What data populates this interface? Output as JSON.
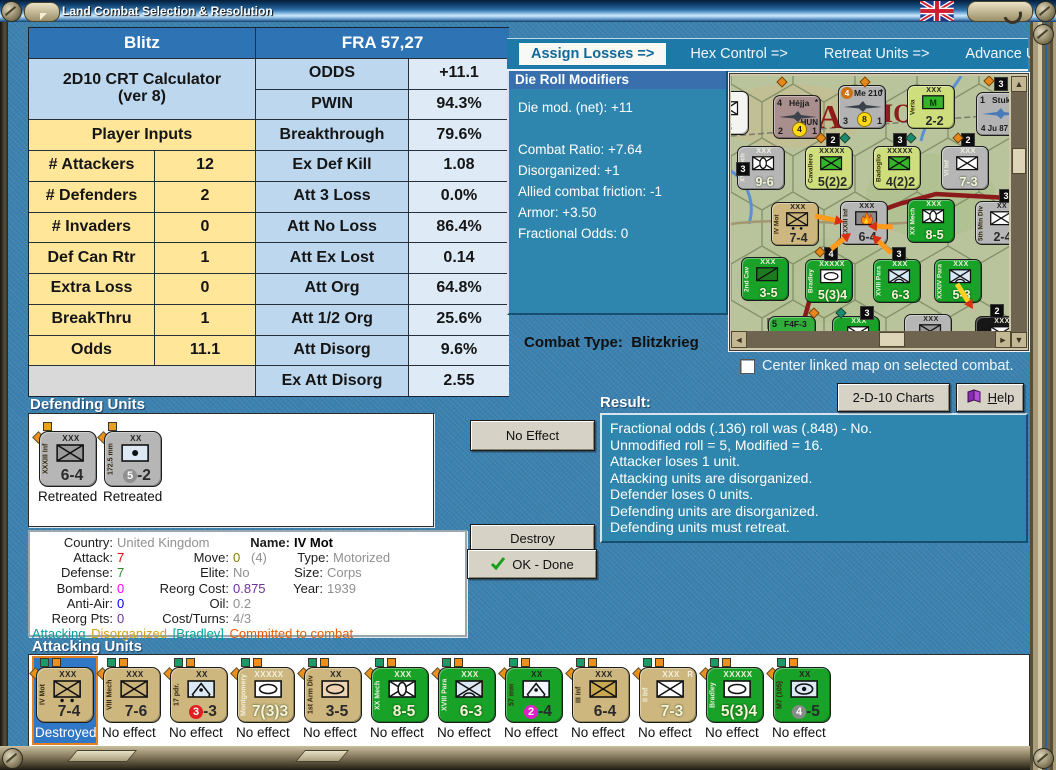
{
  "window": {
    "title": "Land Combat Selection & Resolution"
  },
  "colors": {
    "bg": "#3d83b0",
    "teal_panel": "#2e86ae",
    "panel_title_bar": "#3a6fae",
    "tab_bar": "#1d7aa8",
    "tab_active_text": "#11699b",
    "table_header": "#2e74b5",
    "table_light_blue": "#bdd7ee",
    "table_lighter_blue": "#deebf7",
    "table_yellow": "#ffe699",
    "table_gray": "#d9d9d9",
    "button_face": "#d6d2c6",
    "counter_tan": "#cdb77f",
    "counter_green": "#18a227",
    "counter_gray": "#b6b6b6",
    "counter_ygreen": "#cede7c",
    "selected_blue": "#2f78c8",
    "arrow_orange": "#ff9a1c"
  },
  "tabs": [
    {
      "label": "Assign Losses =>",
      "active": true
    },
    {
      "label": "Hex Control =>",
      "active": false
    },
    {
      "label": "Retreat Units =>",
      "active": false
    },
    {
      "label": "Advance Units",
      "active": false
    }
  ],
  "crt": {
    "left_header": "Blitz",
    "right_header": "FRA 57,27",
    "calc_title_1": "2D10 CRT Calculator",
    "calc_title_2": "(ver 8)",
    "inputs_header": "Player Inputs",
    "inputs": [
      [
        "# Attackers",
        "12"
      ],
      [
        "# Defenders",
        "2"
      ],
      [
        "# Invaders",
        "0"
      ],
      [
        "Def Can Rtr",
        "1"
      ],
      [
        "Extra Loss",
        "0"
      ],
      [
        "BreakThru",
        "1"
      ],
      [
        "Odds",
        "11.1"
      ]
    ],
    "outputs": [
      [
        "ODDS",
        "+11.1"
      ],
      [
        "PWIN",
        "94.3%"
      ],
      [
        "Breakthrough",
        "79.6%"
      ],
      [
        "Ex Def Kill",
        "1.08"
      ],
      [
        "Att 3 Loss",
        "0.0%"
      ],
      [
        "Att No Loss",
        "86.4%"
      ],
      [
        "Att Ex Lost",
        "0.14"
      ],
      [
        "Att Org",
        "64.8%"
      ],
      [
        "Att 1/2 Org",
        "25.6%"
      ],
      [
        "Att Disorg",
        "9.6%"
      ],
      [
        "Ex Att Disorg",
        "2.55"
      ]
    ]
  },
  "die_modifiers": {
    "title": "Die Roll Modifiers",
    "net": "Die mod. (net): +11",
    "lines": [
      "Combat Ratio: +7.64",
      "Disorganized: +1",
      "Allied combat friction: -1",
      "Armor: +3.50",
      "Fractional Odds: 0"
    ]
  },
  "combat_type": {
    "label": "Combat Type:",
    "value": "Blitzkrieg"
  },
  "map_controls": {
    "checkbox_label": "Center linked map on selected combat.",
    "checkbox_checked": false,
    "charts_button": "2-D-10 Charts",
    "help_button": "Help"
  },
  "map": {
    "labels": [
      {
        "t": "RA",
        "x": 62,
        "y": 52,
        "s": 34
      },
      {
        "t": "IO",
        "x": 152,
        "y": 46,
        "s": 26
      }
    ],
    "units": [
      {
        "t": "g",
        "name": "",
        "size": "R",
        "sym": "inf",
        "sym_fill": "#ffffff",
        "str": "3",
        "color": "wht",
        "x": -30,
        "y": 15
      },
      {
        "t": "a",
        "color": "#a98e8e",
        "tl": "4",
        "name": "Héjja",
        "star": "*",
        "extra": "HUN",
        "bl": "2",
        "circ": "4",
        "br": "1",
        "x": 42,
        "y": 19
      },
      {
        "t": "a",
        "color": "#b3b3b3",
        "tl_circ": "#d07010",
        "tl": "4",
        "name": "Me 210",
        "star": "*",
        "bl": "3",
        "circ": "8",
        "br": "1",
        "x": 107,
        "y": 9
      },
      {
        "t": "g",
        "name": "Veria",
        "size": "XXX",
        "sym": "m",
        "sym_fill": "#35b42a",
        "str": "2-2",
        "color": "ygreen",
        "x": 176,
        "y": 9
      },
      {
        "t": "a",
        "color": "#b3b3b3",
        "tl": "1",
        "name": "Stuka",
        "sub": "4  Ju 87",
        "plane_color": "#4a7ab8",
        "x": 245,
        "y": 16
      },
      {
        "t": "g",
        "name": "XVI Mech",
        "size": "XXX",
        "sym": "mech",
        "sym_fill": "#ffffff",
        "str": "9-6",
        "color": "gray",
        "light": true,
        "x": 6,
        "y": 70
      },
      {
        "t": "g",
        "name": "Cavallero",
        "size": "XXXXX",
        "sym": "inf",
        "sym_fill": "#35b42a",
        "str": "5(2)2",
        "color": "ygreen",
        "x": 74,
        "y": 70
      },
      {
        "t": "g",
        "name": "Badoglio",
        "size": "XXXXX",
        "sym": "inf",
        "sym_fill": "#35b42a",
        "str": "4(2)2",
        "color": "ygreen",
        "x": 142,
        "y": 70
      },
      {
        "t": "g",
        "name": "VI Inf",
        "size": "XXX",
        "sym": "inf",
        "sym_fill": "#ffffff",
        "str": "7-3",
        "color": "gray",
        "light": true,
        "x": 210,
        "y": 70
      },
      {
        "t": "g",
        "name": "IV Mot",
        "size": "XXX",
        "sym": "mot",
        "sym_fill": "#c9b378",
        "str": "7-4",
        "color": "tan",
        "x": 40,
        "y": 126
      },
      {
        "t": "g",
        "name": "XXXIII Inf",
        "size": "XXX",
        "sym": "fire",
        "sym_fill": "#8a8a8a",
        "str": "6-4",
        "color": "gray",
        "x": 109,
        "y": 125
      },
      {
        "t": "g",
        "name": "XX Mech",
        "size": "XXX",
        "sym": "mech",
        "sym_fill": "#ffffff",
        "str": "8-5",
        "color": "green",
        "light": true,
        "x": 176,
        "y": 123
      },
      {
        "t": "g",
        "name": "5th Mtn Div",
        "size": "XX",
        "sym": "inf",
        "sym_fill": "#ffffff",
        "str": "2-4",
        "color": "gray",
        "x": 244,
        "y": 125
      },
      {
        "t": "g",
        "name": "2nd Cav",
        "size": "XXX",
        "sym": "cav",
        "sym_fill": "#1e7a1e",
        "str": "3-5",
        "color": "green",
        "light": true,
        "x": 10,
        "y": 181
      },
      {
        "t": "g",
        "name": "Bradley",
        "size": "XXXXX",
        "sym": "hq",
        "sym_fill": "#ffffff",
        "str": "5(3)4",
        "color": "green",
        "light": true,
        "x": 74,
        "y": 183
      },
      {
        "t": "g",
        "name": "XVIII Para",
        "size": "XXX",
        "sym": "para",
        "sym_fill": "#d8e8f4",
        "str": "6-3",
        "color": "green",
        "light": true,
        "x": 142,
        "y": 183
      },
      {
        "t": "g",
        "name": "XXXIV Para",
        "size": "XXX",
        "sym": "para",
        "sym_fill": "#d8e8f4",
        "str": "5-3",
        "color": "green",
        "light": true,
        "x": 203,
        "y": 183
      },
      {
        "t": "a",
        "color": "#2fae3a",
        "tl": "5",
        "name": "F4F-3",
        "x": 37,
        "y": 240
      },
      {
        "t": "g",
        "name": "I Inf",
        "size": "XXX",
        "sym": "inf",
        "sym_fill": "#ffffff",
        "str": "",
        "color": "green",
        "light": true,
        "x": 101,
        "y": 240
      },
      {
        "t": "g",
        "name": "",
        "size": "XXX",
        "sym": "inf",
        "sym_fill": "#9a9a9a",
        "str": "",
        "color": "gray",
        "x": 173,
        "y": 238
      },
      {
        "t": "g",
        "name": "Min",
        "size": "XXX",
        "sym": "inf",
        "sym_fill": "#ffffff",
        "str": "",
        "color": "black",
        "light": true,
        "x": 244,
        "y": 240
      }
    ],
    "badges": [
      {
        "x": 263,
        "y": 1,
        "n": "3"
      },
      {
        "x": 95,
        "y": 57,
        "n": "2"
      },
      {
        "x": 162,
        "y": 57,
        "n": "3"
      },
      {
        "x": 230,
        "y": 57,
        "n": "2"
      },
      {
        "x": 5,
        "y": 86,
        "n": "3"
      },
      {
        "x": 268,
        "y": 113,
        "n": "3"
      },
      {
        "x": 93,
        "y": 171,
        "n": "4"
      },
      {
        "x": 161,
        "y": 171,
        "n": "3"
      },
      {
        "x": 129,
        "y": 230,
        "n": "3"
      },
      {
        "x": 259,
        "y": 228,
        "n": "2"
      }
    ],
    "dots": [
      {
        "x": 86,
        "y": 58,
        "c": "#e8881a"
      },
      {
        "x": 110,
        "y": 58,
        "c": "#1a8a72"
      },
      {
        "x": 176,
        "y": 58,
        "c": "#1a8a72"
      },
      {
        "x": 223,
        "y": 58,
        "c": "#e8881a"
      },
      {
        "x": 47,
        "y": 2,
        "c": "#e8881a"
      },
      {
        "x": 130,
        "y": 2,
        "c": "#e8881a"
      },
      {
        "x": 85,
        "y": 172,
        "c": "#e8881a"
      },
      {
        "x": 106,
        "y": 233,
        "c": "#1a8a72"
      },
      {
        "x": 79,
        "y": 233,
        "c": "#e8881a"
      },
      {
        "x": 254,
        "y": 1,
        "c": "#e8881a"
      }
    ],
    "arrows": [
      {
        "x1": 84,
        "y1": 140,
        "x2": 113,
        "y2": 146,
        "c": "#ff9a1c"
      },
      {
        "x1": 162,
        "y1": 151,
        "x2": 137,
        "y2": 150,
        "c": "#ff9a1c"
      },
      {
        "x1": 100,
        "y1": 173,
        "x2": 120,
        "y2": 157,
        "c": "#ff9a1c"
      },
      {
        "x1": 160,
        "y1": 177,
        "x2": 141,
        "y2": 159,
        "c": "#ff9a1c"
      },
      {
        "x1": 226,
        "y1": 208,
        "x2": 242,
        "y2": 233,
        "c": "#ffd024"
      }
    ]
  },
  "result": {
    "title": "Result:",
    "lines": [
      "Fractional odds (.136) roll was (.848)  - No.",
      "Unmodified roll = 5, Modified = 16.",
      "Attacker loses 1 unit.",
      "Attacking units are disorganized.",
      "Defender loses 0 units.",
      "Defending units are disorganized.",
      "Defending units must retreat."
    ]
  },
  "defending": {
    "title": "Defending Units",
    "units": [
      {
        "name": "XXXIII Inf",
        "size": "XXX",
        "sym": "inf",
        "sym_fill": "#9a9a9a",
        "strength": "6-4",
        "color": "gray",
        "label": "Retreated"
      },
      {
        "name": "172.5 mm",
        "size": "XX",
        "sym": "art",
        "sym_fill": "#dce9f5",
        "strength": "5-2",
        "circle": "#909090",
        "color": "gray",
        "label": "Retreated"
      }
    ]
  },
  "action_buttons": {
    "no_effect": "No Effect",
    "destroy": "Destroy",
    "ok_done": "OK - Done"
  },
  "unit_info": {
    "country_label": "Country:",
    "country": "United Kingdom",
    "name_label": "Name:",
    "name": "IV Mot",
    "attack_label": "Attack:",
    "attack": "7",
    "move_label": "Move:",
    "move": "0",
    "move_paren": "(4)",
    "type_label": "Type:",
    "type": "Motorized",
    "defense_label": "Defense:",
    "defense": "7",
    "elite_label": "Elite:",
    "elite": "No",
    "size_label": "Size:",
    "size": "Corps",
    "bombard_label": "Bombard:",
    "bombard": "0",
    "reorg_cost_label": "Reorg Cost:",
    "reorg_cost": "0.875",
    "year_label": "Year:",
    "year": "1939",
    "antiair_label": "Anti-Air:",
    "antiair": "0",
    "oil_label": "Oil:",
    "oil": "0.2",
    "reorg_pts_label": "Reorg Pts:",
    "reorg_pts": "0",
    "cost_turns_label": "Cost/Turns:",
    "cost_turns": "4/3",
    "status": [
      "Attacking",
      "Disorganized",
      "[Bradley]",
      "Committed to combat"
    ]
  },
  "attacking": {
    "title": "Attacking Units",
    "units": [
      {
        "name": "IV Mot",
        "size": "XXX",
        "sym": "mot",
        "sym_fill": "#c9b378",
        "strength": "7-4",
        "color": "tan",
        "label": "Destroyed",
        "selected": true
      },
      {
        "name": "VIII Mech",
        "size": "XXX",
        "sym": "inf",
        "sym_fill": "#c9b378",
        "strength": "7-6",
        "color": "tan",
        "label": "No effect"
      },
      {
        "name": "17 pdr.",
        "size": "XX",
        "sym": "at",
        "sym_fill": "#dce9f5",
        "strength": "3-3",
        "circle": "#e02020",
        "color": "tan",
        "label": "No effect"
      },
      {
        "name": "Montgomery",
        "size": "XXXXX",
        "sym": "hq",
        "sym_fill": "#ffffff",
        "strength": "7(3)3",
        "color": "tan",
        "light": true,
        "label": "No effect"
      },
      {
        "name": "1st Arm Div",
        "size": "XX",
        "sym": "armor",
        "sym_fill": "#eed3b3",
        "strength": "3-5",
        "color": "tan",
        "label": "No effect"
      },
      {
        "name": "XX Mech",
        "size": "XXX",
        "sym": "mech",
        "sym_fill": "#ffffff",
        "strength": "8-5",
        "color": "green",
        "light": true,
        "label": "No effect"
      },
      {
        "name": "XVIII Para",
        "size": "XXX",
        "sym": "para",
        "sym_fill": "#dce9f5",
        "strength": "6-3",
        "color": "green",
        "light": true,
        "label": "No effect"
      },
      {
        "name": "57 mm",
        "size": "XX",
        "sym": "at",
        "sym_fill": "#f2f6fa",
        "strength": "2-4",
        "circle": "#e020c8",
        "color": "green",
        "label": "No effect"
      },
      {
        "name": "III Inf",
        "size": "XXX",
        "sym": "inf",
        "sym_fill": "#c9a94f",
        "strength": "6-4",
        "color": "tan",
        "label": "No effect"
      },
      {
        "name": "II Inf",
        "size": "XXX",
        "sup": "R",
        "sym": "inf",
        "sym_fill": "#ffffff",
        "strength": "7-3",
        "color": "tan",
        "light": true,
        "label": "No effect"
      },
      {
        "name": "Bradley",
        "size": "XXXXX",
        "sym": "hq",
        "sym_fill": "#ffffff",
        "strength": "5(3)4",
        "color": "green",
        "light": true,
        "label": "No effect"
      },
      {
        "name": "M7 (105)",
        "size": "XX",
        "sym": "spart",
        "sym_fill": "#dce9f5",
        "strength": "4-5",
        "circle": "#8a8a8a",
        "color": "green",
        "label": "No effect"
      }
    ]
  }
}
